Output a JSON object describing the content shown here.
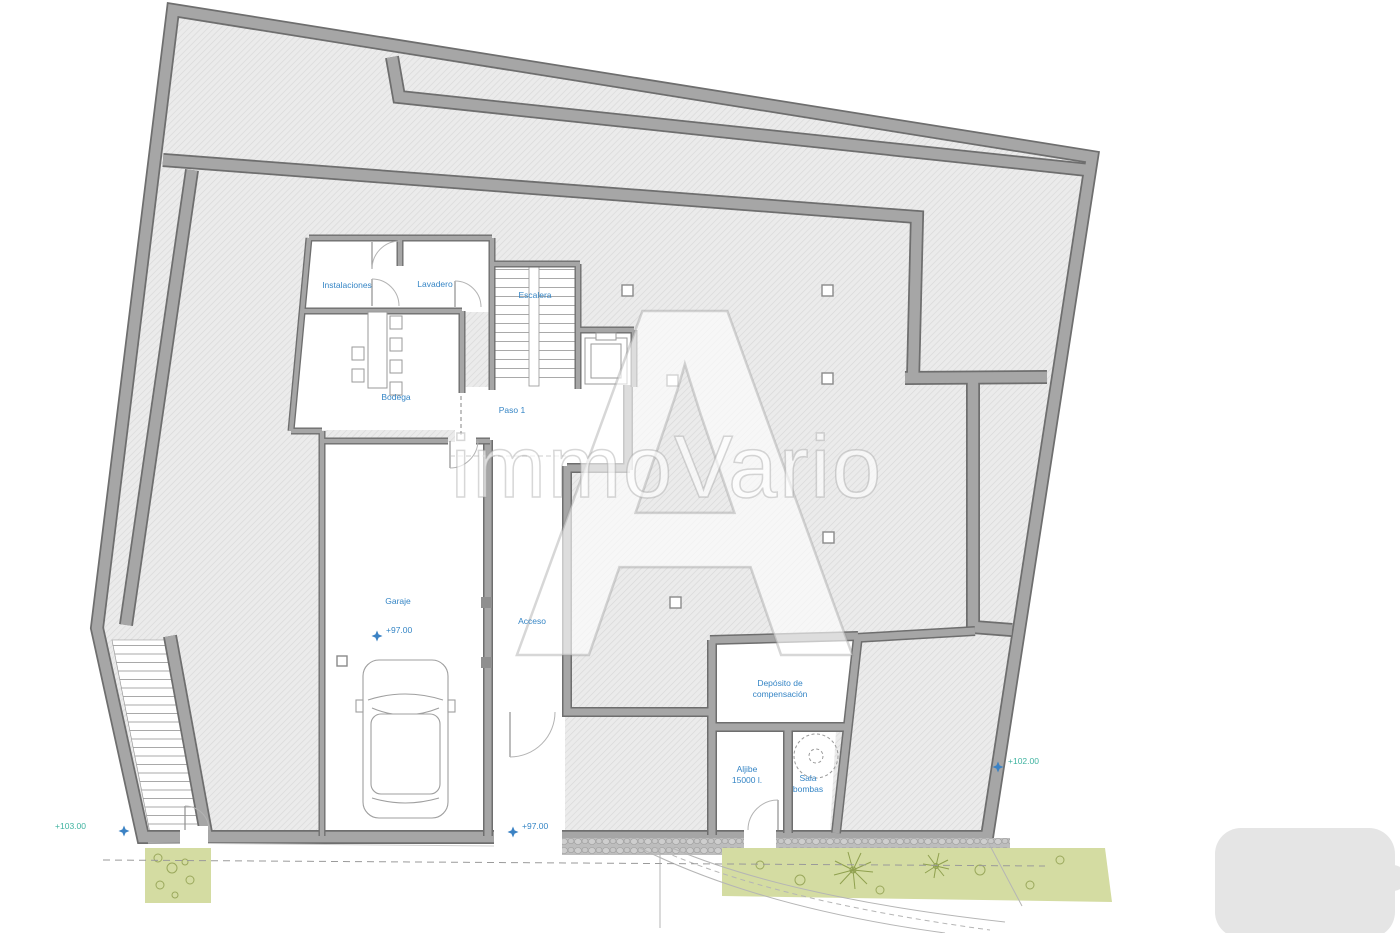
{
  "plan": {
    "rooms": {
      "instalaciones": "Instalaciones",
      "lavadero": "Lavadero",
      "escalera": "Escalera",
      "bodega": "Bodega",
      "paso1": "Paso 1",
      "garaje": "Garaje",
      "acceso": "Acceso",
      "deposito_l1": "Depósito de",
      "deposito_l2": "compensación",
      "aljibe_l1": "Aljibe",
      "aljibe_l2": "15000 l.",
      "sala_l1": "Sala",
      "sala_l2": "bombas"
    },
    "levels": {
      "garaje": "+97.00",
      "entrada": "+97.00",
      "este": "+102.00",
      "oeste": "+103.00"
    },
    "colors": {
      "label_blue": "#3585c5",
      "level_teal": "#3fb3a0",
      "marker_blue": "#3b82c4",
      "wall": "#a6a6a6",
      "wall_edge": "#6e6e6e",
      "hatch_bg": "#ebebeb",
      "vegetation": "#d4dca2"
    }
  },
  "watermark": {
    "letter": "A",
    "brand": "immoVario"
  }
}
